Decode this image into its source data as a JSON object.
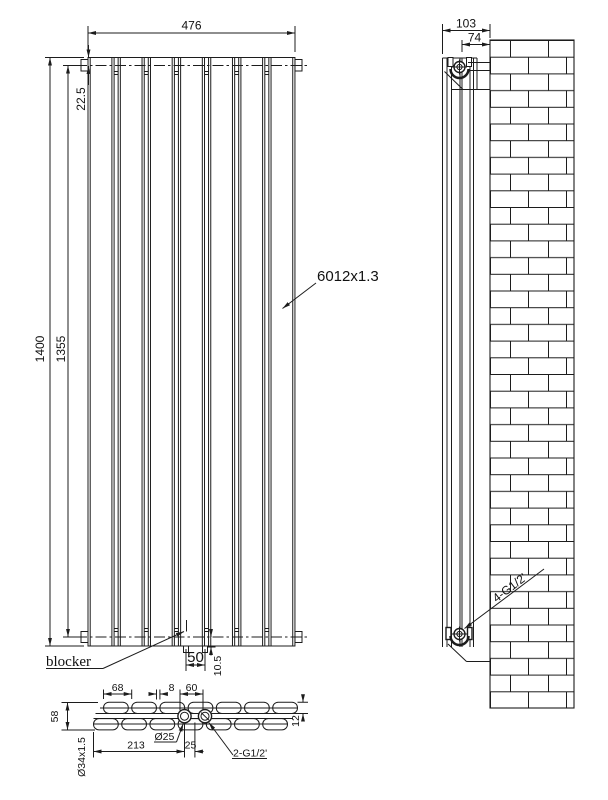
{
  "drawing": {
    "colors": {
      "background": "#ffffff",
      "line": "#1c1c1c"
    },
    "front_view": {
      "panel_count": 7,
      "dim_width": "476",
      "dim_top_inset": "22.5",
      "dim_height_overall": "1400",
      "dim_height_connections": "1355",
      "dim_stub_spacing": "50",
      "dim_bottom_inset": "10.5",
      "label_blocker": "blocker",
      "label_panel_spec": "6012x1.3"
    },
    "side_view": {
      "dim_depth_overall": "103",
      "dim_pipe_to_wall": "74",
      "label_connections": "4-G1/2'"
    },
    "section_view": {
      "tube_count_per_row": 7,
      "dim_panel_pitch": "68",
      "dim_panel_gap": "8",
      "dim_port_span": "60",
      "dim_depth_overall": "58",
      "dim_tube_depth": "12",
      "dim_port_offset": "213",
      "dim_port_to_center": "25",
      "label_port_diameter": "Ø25",
      "label_port_thread": "2-G1/2'",
      "label_header_pipe": "Ø34x1.5"
    }
  }
}
